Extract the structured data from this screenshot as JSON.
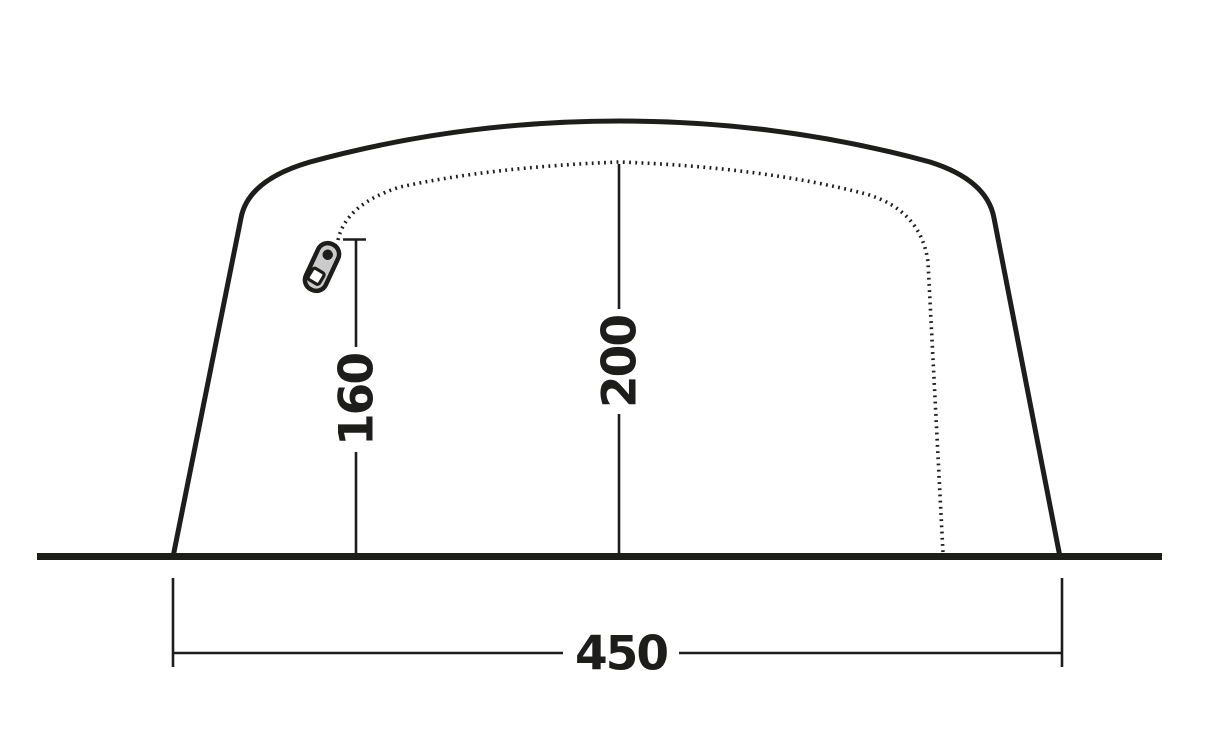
{
  "diagram": {
    "title": "tent-side-elevation-dimension-diagram",
    "dimensions": [
      {
        "id": "door-zipper-height",
        "label": "160",
        "orientation": "vertical"
      },
      {
        "id": "inner-peak-height",
        "label": "200",
        "orientation": "vertical"
      },
      {
        "id": "base-width",
        "label": "450",
        "orientation": "horizontal"
      }
    ],
    "colors": {
      "line": "#1d1d1b",
      "zipper_fill": "#cbcbcb",
      "hole_fill": "#ffffff",
      "background": "#ffffff"
    },
    "icons": {
      "zipper_pull": "zipper-pull-icon"
    }
  }
}
